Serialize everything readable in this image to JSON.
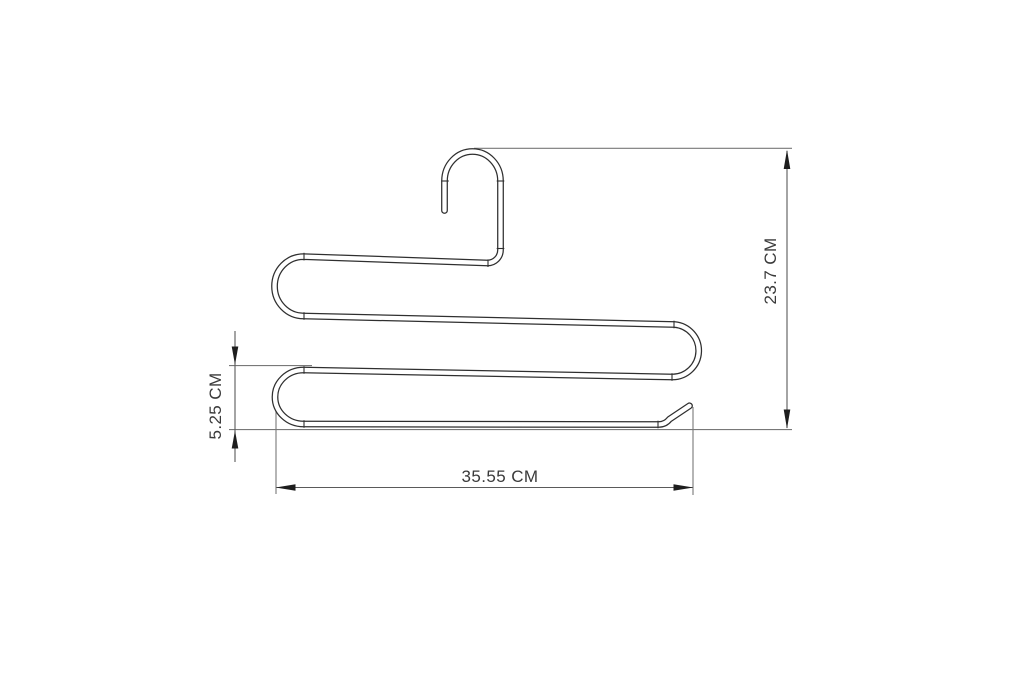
{
  "drawing": {
    "dimensions": {
      "height_label": "23.7 CM",
      "tier_spacing_label": "5.25 CM",
      "width_label": "35.55 CM"
    }
  },
  "colors": {
    "background": "#ffffff",
    "wire_outline": "#2f2f2f",
    "extension_line": "#787878",
    "dimension_line": "#5a5a5a",
    "arrow": "#1e1e1e",
    "label_text": "#3a3a3a"
  }
}
